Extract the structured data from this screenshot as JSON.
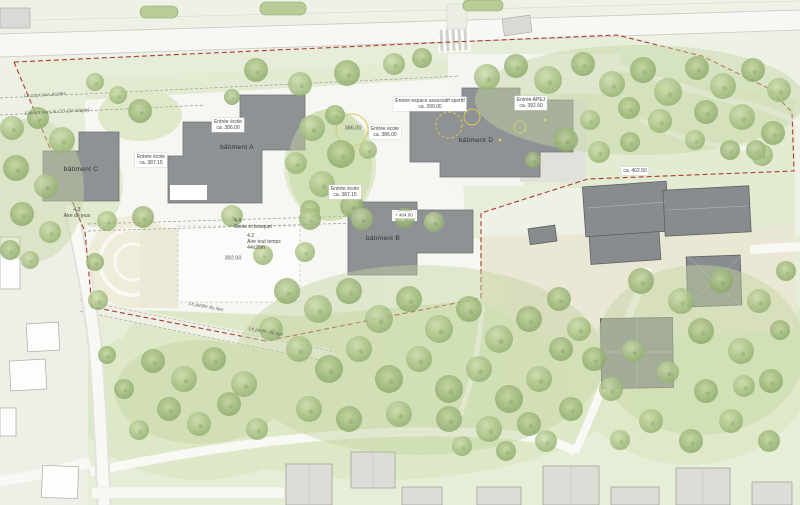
{
  "buildings": {
    "a": "bâtiment A",
    "b": "bâtiment B",
    "c": "bâtiment C",
    "d": "bâtiment D"
  },
  "entrances": {
    "school_a": {
      "line1": "Entrée école",
      "line2": "ca. 386.00"
    },
    "school_c": {
      "line1": "Entrée école",
      "line2": "ca. 387.15"
    },
    "school_b": {
      "line1": "Entrée école",
      "line2": "ca. 387.15"
    },
    "school_d": {
      "line1": "Entrée école",
      "line2": "ca. 386.00"
    },
    "sport": {
      "line1": "Entrée espace associatif sportif",
      "line2": "ca. 390.00"
    },
    "apej": {
      "line1": "Entrée APEJ",
      "line2": "ca. 392.50"
    },
    "east": {
      "line1": "ca. 402.50"
    }
  },
  "elevations": {
    "yard": "386.00",
    "field": "392.00",
    "roof_b": "+ 404.00"
  },
  "areas": {
    "playground": {
      "num": "4.3",
      "label": "Aire de jeux"
    },
    "sente": {
      "num": "4.4",
      "label": "Sente et bosquet"
    },
    "allweather": {
      "num": "4.2",
      "label": "Aire tout temps",
      "size": "44x26m"
    }
  },
  "paths": {
    "cour": "La cour aux écoles",
    "avant": "L'avant vers le CO (2e étape)",
    "jardin_1": "Le jardin du lien",
    "jardin_2": "Le jardin du lien"
  },
  "colors": {
    "boundary": "#b03a2e",
    "building_new": "#8f9294",
    "building_existing": "#898c8e",
    "lawn": "#e6edd7",
    "hard_surface": "#f7f7f3",
    "beige": "#ece8d5",
    "tree_green": "#a9c184",
    "accent_yellow": "#dcc84f"
  }
}
